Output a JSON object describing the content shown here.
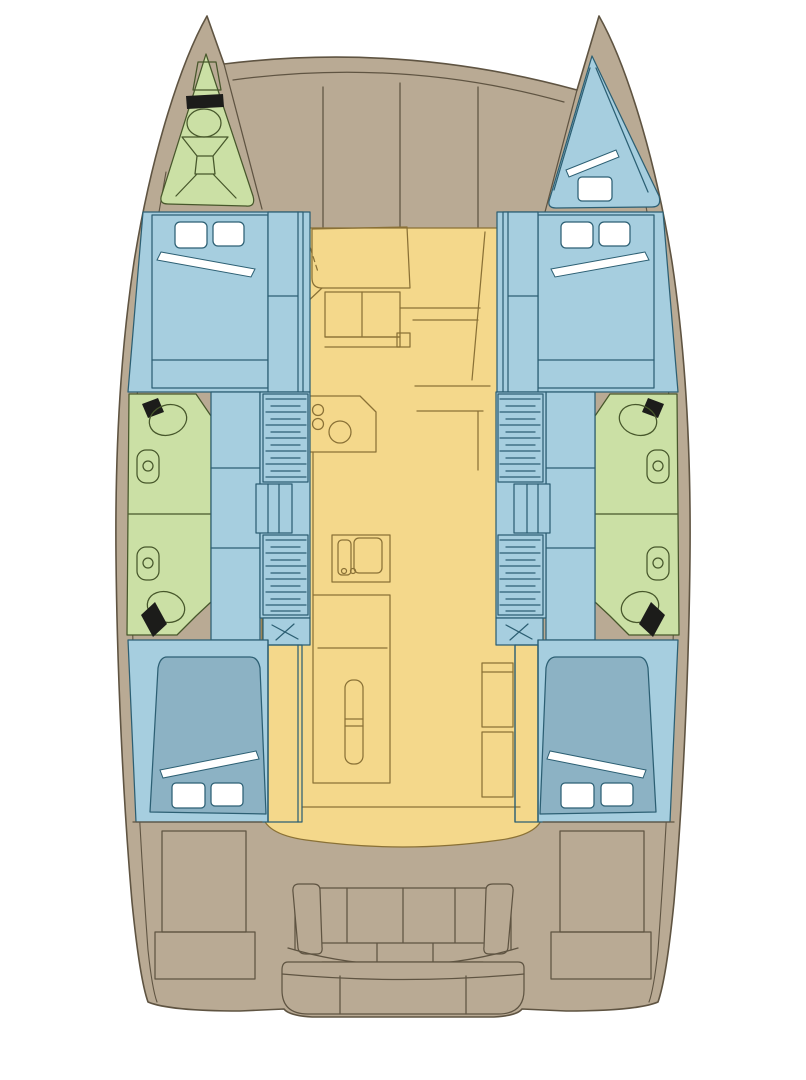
{
  "diagram": {
    "type": "yacht-deck-plan",
    "vessel": "catamaran",
    "view": "top-down interior layout, bow at top / stern at bottom",
    "regions": [
      {
        "id": "port-bow-locker",
        "color_key": "wet"
      },
      {
        "id": "starboard-bow-cabin",
        "color_key": "cabin"
      },
      {
        "id": "foredeck",
        "color_key": "deck"
      },
      {
        "id": "port-forward-cabin",
        "color_key": "cabin"
      },
      {
        "id": "starboard-forward-cabin",
        "color_key": "cabin"
      },
      {
        "id": "port-heads-forward",
        "color_key": "wet"
      },
      {
        "id": "port-heads-aft",
        "color_key": "wet"
      },
      {
        "id": "starboard-heads-forward",
        "color_key": "wet"
      },
      {
        "id": "starboard-heads-aft",
        "color_key": "wet"
      },
      {
        "id": "salon-galley",
        "color_key": "salon"
      },
      {
        "id": "port-stairs",
        "color_key": "cabin"
      },
      {
        "id": "starboard-stairs",
        "color_key": "cabin"
      },
      {
        "id": "port-aft-cabin",
        "color_key": "cabin"
      },
      {
        "id": "starboard-aft-cabin",
        "color_key": "cabin"
      },
      {
        "id": "cockpit",
        "color_key": "deck"
      },
      {
        "id": "aft-bench",
        "color_key": "deck"
      },
      {
        "id": "swim-platform",
        "color_key": "deck"
      }
    ],
    "counts": {
      "double-berths": 4,
      "bow-berths": 1,
      "toilets": 4,
      "washbasins": 4,
      "stair-runs": 4,
      "galley-burners": 3
    }
  },
  "colors": {
    "background": "#ffffff",
    "deck": "#b9aa94",
    "deck_line": "#5f5442",
    "salon": "#f4d88b",
    "salon_line": "#8a7136",
    "cabin": "#a6cedf",
    "cabin_line": "#2c5f73",
    "berth": "#8cb2c4",
    "wet": "#cbe0a5",
    "wet_line": "#47572b",
    "fixture_white": "#ffffff",
    "fixture_black": "#1c1c1a"
  }
}
